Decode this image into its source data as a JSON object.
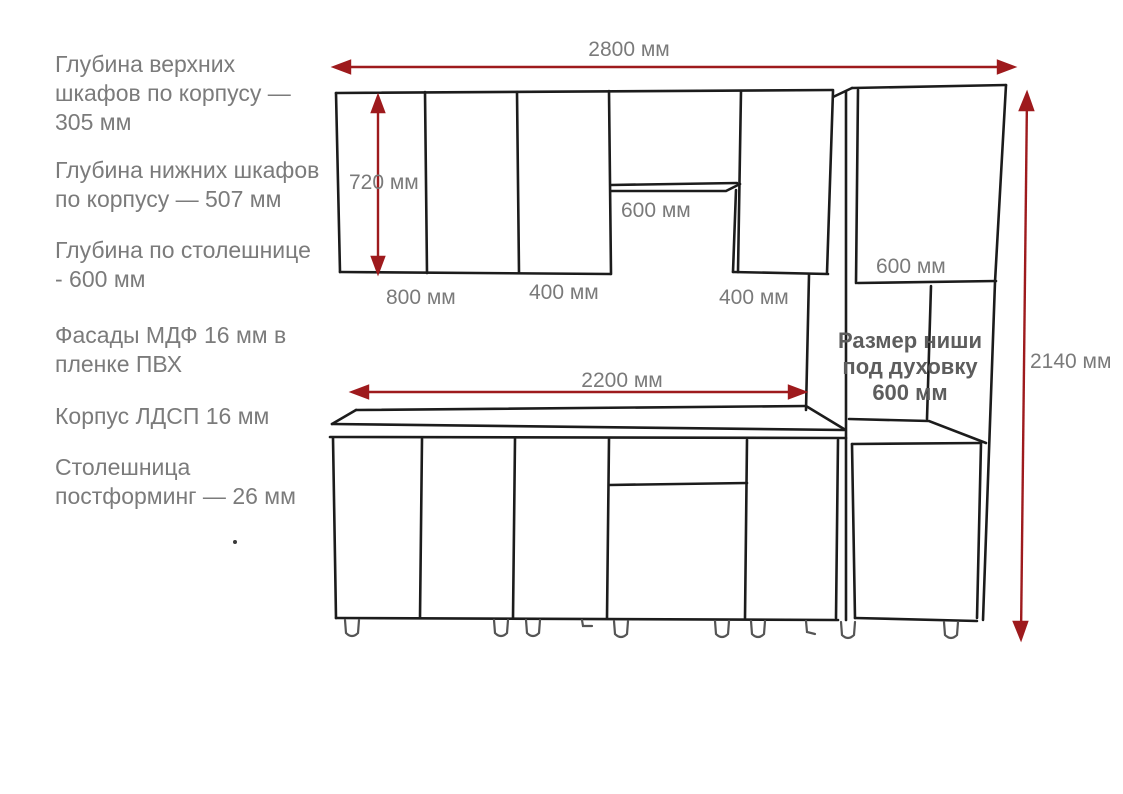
{
  "notes": [
    {
      "lines": [
        "Глубина верхних",
        "шкафов по корпусу —",
        "305 мм"
      ]
    },
    {
      "lines": [
        "Глубина нижних шкафов",
        "по корпусу — 507 мм"
      ]
    },
    {
      "lines": [
        "Глубина по столешнице",
        "- 600 мм"
      ]
    },
    {
      "lines": [
        "Фасады МДФ 16 мм в",
        "пленке ПВХ"
      ]
    },
    {
      "lines": [
        "Корпус ЛДСП 16 мм"
      ]
    },
    {
      "lines": [
        "Столешница",
        "постформинг — 26 мм"
      ]
    }
  ],
  "dimensions": {
    "total_width": "2800 мм",
    "upper_cabinet_height": "720 мм",
    "cabinet_800": "800 мм",
    "cabinet_400_left": "400 мм",
    "hood_gap_width": "600 мм",
    "cabinet_400_right": "400 мм",
    "niche_width": "600 мм",
    "countertop_width": "2200 мм",
    "total_height": "2140 мм"
  },
  "oven_niche": {
    "lines": [
      "Размер ниши",
      "под духовку",
      "600 мм"
    ]
  },
  "colors": {
    "sketch_line": "#1c1c1c",
    "dimension_arrow": "#9e1a1d",
    "label_text": "#7a7a7a",
    "note_text": "#7b7b7b",
    "niche_text": "#5d5d5d",
    "background": "#ffffff"
  }
}
